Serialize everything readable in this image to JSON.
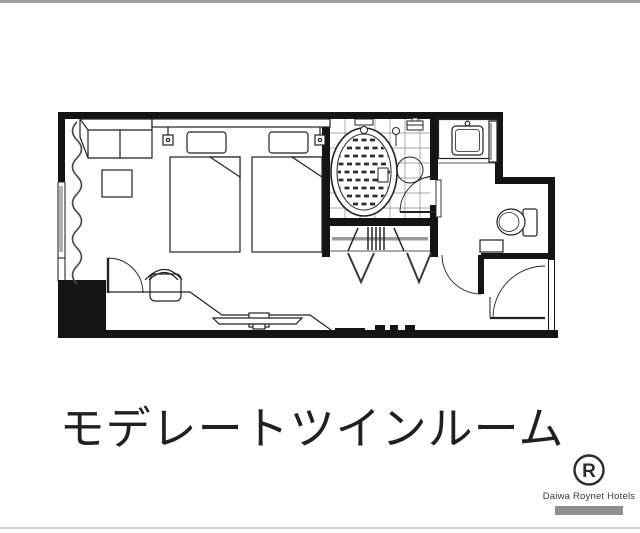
{
  "caption": {
    "title": "モデレートツインルーム"
  },
  "brand": {
    "name": "Daiwa Roynet Hotels",
    "monogram": "R"
  },
  "colors": {
    "wall": "#141414",
    "line": "#222222",
    "grid": "#8a8a8a",
    "rod": "#9a9a9a",
    "curtain": "#4a4a4a",
    "divider_top": "#9e9e9e",
    "divider_bottom": "#d2d2d2",
    "badge": "#8f8f8f",
    "background": "#ffffff"
  },
  "floorplan": {
    "rooms": [
      "bedroom",
      "bathroom",
      "washroom",
      "toilet-room",
      "closet",
      "entrance-corridor"
    ],
    "fixtures": [
      "twin-bed-left",
      "twin-bed-right",
      "headboard",
      "reading-lights",
      "sofa",
      "side-table",
      "desk-counter",
      "chair",
      "tv",
      "bathtub",
      "shower",
      "wash-basin",
      "mirror",
      "toilet",
      "shelf",
      "hanger-rod",
      "luggage-rack",
      "window-curtain",
      "entrance-door"
    ]
  }
}
